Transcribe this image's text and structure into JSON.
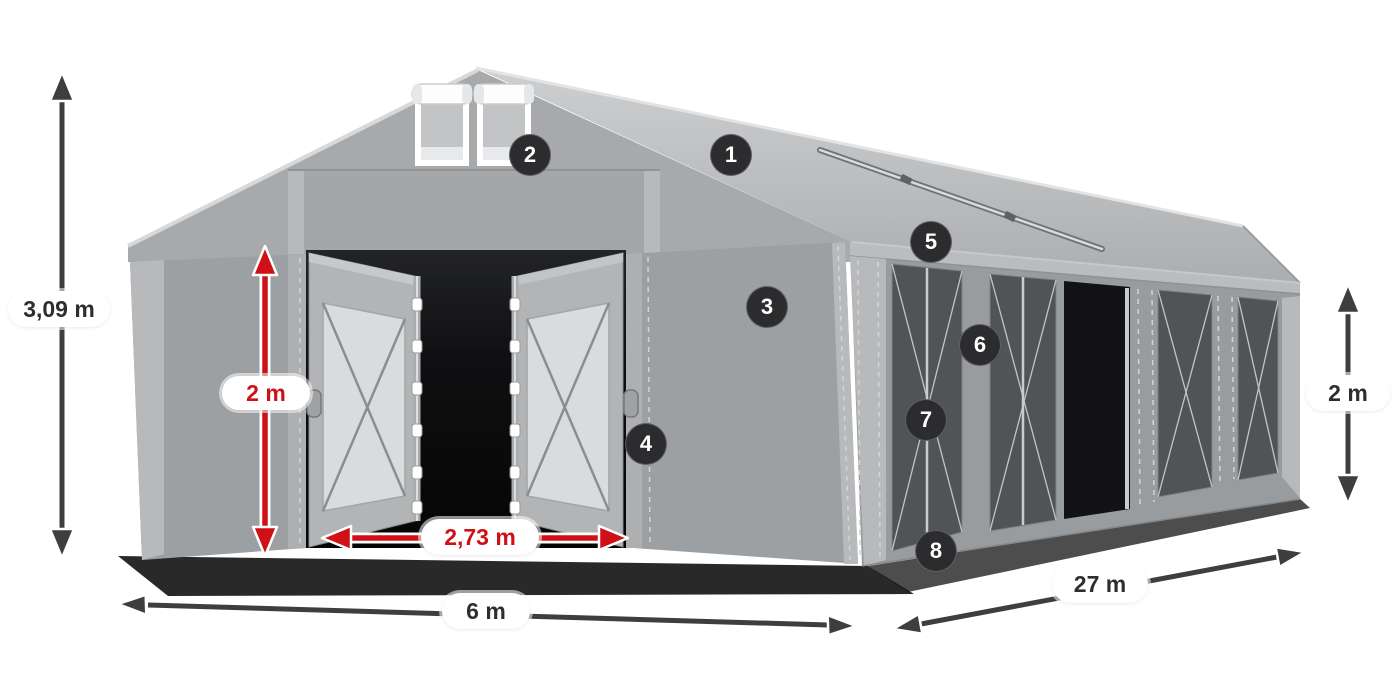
{
  "diagram": {
    "dimensions": {
      "total_height": "3,09 m",
      "entrance_height": "2 m",
      "entrance_width": "2,73 m",
      "tent_width": "6 m",
      "tent_length": "27 m",
      "side_height": "2 m"
    },
    "markers": [
      "1",
      "2",
      "3",
      "4",
      "5",
      "6",
      "7",
      "8"
    ]
  },
  "colors": {
    "accent_red": "#cf1117",
    "arrow_dark": "#3e3e3e",
    "badge_bg": "#2c2c2e",
    "pill_text": "#2e2e2e",
    "tent_wall": "#9da0a2",
    "tent_roof_light": "#cdcfd0",
    "tent_roof_dark": "#abadaf",
    "mesh_dark": "#515457"
  }
}
